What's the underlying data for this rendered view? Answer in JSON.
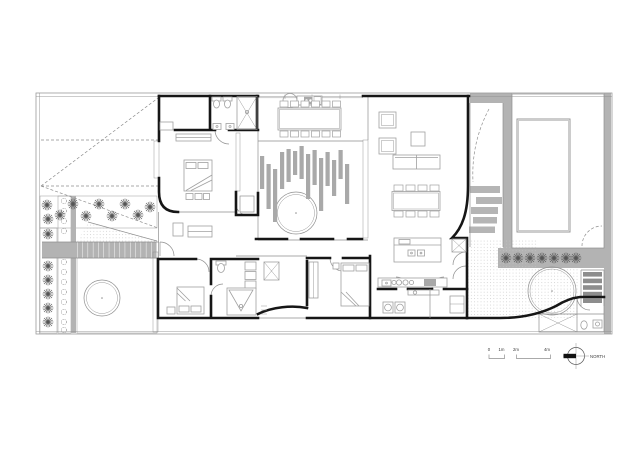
{
  "drawing": {
    "kind": "architectural-floor-plan",
    "north_label": "NORTH",
    "scale_bar": {
      "ticks": [
        {
          "label": "0",
          "x": 489
        },
        {
          "label": "1m",
          "x": 501.5
        },
        {
          "label": "2m",
          "x": 516
        },
        {
          "label": "4m",
          "x": 547
        }
      ]
    }
  },
  "colors": {
    "wall": "#161616",
    "thin": "#8f8f8f",
    "furniture": "#a0a0a0",
    "paving": "#b3b3b3",
    "stone": "#b5b5b5",
    "tread": "#8d8d8d",
    "slat": "#a9a9a9",
    "plant": "#4f4f4f",
    "boundary": "#9b9b9b",
    "label": "#3c3c3c"
  },
  "plan": {
    "pergola_slats": [
      [
        260,
        156,
        189
      ],
      [
        266.5,
        164,
        209
      ],
      [
        273,
        169,
        222
      ],
      [
        280,
        152,
        189
      ],
      [
        286.5,
        149,
        182
      ],
      [
        293,
        151,
        175
      ],
      [
        299.5,
        146,
        179
      ],
      [
        306,
        154,
        199
      ],
      [
        312.5,
        150,
        185
      ],
      [
        319,
        158,
        211
      ],
      [
        325.5,
        152,
        186
      ],
      [
        332,
        160,
        196
      ],
      [
        338.5,
        150,
        179
      ],
      [
        345,
        164,
        204
      ]
    ],
    "stepping_stones": [
      [
        470,
        186,
        30,
        7
      ],
      [
        476,
        197,
        26,
        7
      ],
      [
        471,
        207,
        27,
        7
      ],
      [
        473,
        217,
        24,
        6.5
      ],
      [
        469,
        226.5,
        26,
        6.5
      ]
    ],
    "stair_treads": [
      [
        583,
        272,
        19,
        4.6
      ],
      [
        583,
        278.6,
        19,
        4.6
      ],
      [
        583,
        285.2,
        19,
        4.6
      ],
      [
        583,
        291.8,
        19,
        4.6
      ],
      [
        583,
        298.4,
        19,
        4.6
      ]
    ],
    "plants": {
      "front_bed": [
        [
          47,
          205
        ],
        [
          60,
          215
        ],
        [
          73,
          204
        ],
        [
          86,
          216
        ],
        [
          99,
          204
        ],
        [
          112,
          216
        ],
        [
          125,
          204
        ],
        [
          138,
          215
        ],
        [
          150,
          207
        ]
      ],
      "left_column": [
        [
          48,
          219
        ],
        [
          48,
          234
        ],
        [
          48,
          266
        ],
        [
          48,
          280
        ],
        [
          48,
          294
        ],
        [
          48,
          308
        ],
        [
          48,
          322
        ]
      ],
      "pool_row": [
        [
          506,
          258
        ],
        [
          518,
          258
        ],
        [
          530,
          258
        ],
        [
          542,
          258
        ],
        [
          554,
          258
        ],
        [
          566,
          258
        ],
        [
          576,
          258
        ]
      ],
      "hedge": [
        [
          64,
          201
        ],
        [
          64,
          211
        ],
        [
          64,
          221
        ],
        [
          64,
          231
        ],
        [
          64,
          262
        ],
        [
          64,
          272
        ],
        [
          64,
          282
        ],
        [
          64,
          292
        ],
        [
          64,
          302
        ],
        [
          64,
          312
        ],
        [
          64,
          322
        ],
        [
          64,
          330
        ]
      ]
    },
    "chairs": {
      "dining_top": {
        "xs": [
          280,
          290.5,
          301,
          311.5,
          322,
          332.5
        ],
        "w": 8,
        "h": 6,
        "y_top": 101,
        "y_bottom": 131
      },
      "dining_living": {
        "xs": [
          394,
          406,
          418,
          430
        ],
        "w": 9,
        "h": 6,
        "y_top": 185,
        "y_bottom": 211
      }
    }
  }
}
